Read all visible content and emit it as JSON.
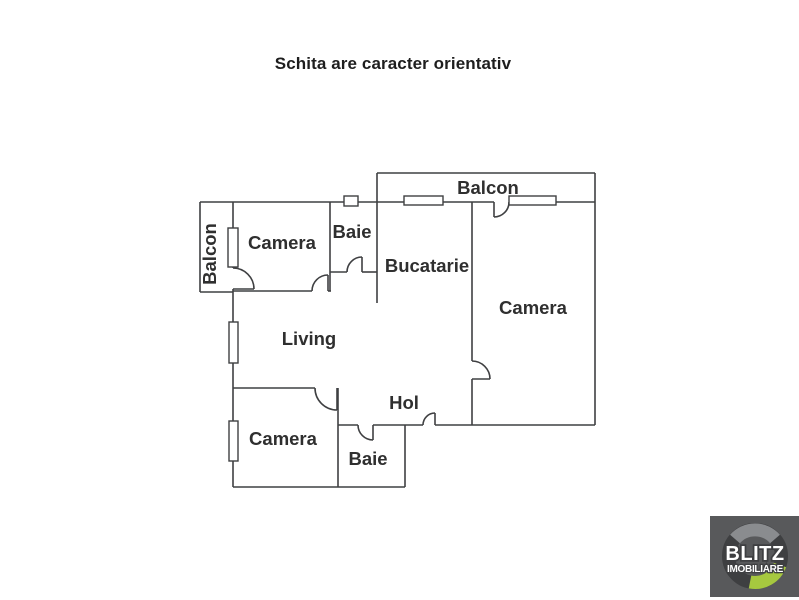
{
  "title": "Schita are caracter orientativ",
  "floorplan": {
    "rooms": [
      {
        "id": "balcon-left",
        "label": "Balcon"
      },
      {
        "id": "camera-top-left",
        "label": "Camera"
      },
      {
        "id": "baie-top",
        "label": "Baie"
      },
      {
        "id": "bucatarie",
        "label": "Bucatarie"
      },
      {
        "id": "balcon-top",
        "label": "Balcon"
      },
      {
        "id": "camera-right",
        "label": "Camera"
      },
      {
        "id": "living",
        "label": "Living"
      },
      {
        "id": "hol",
        "label": "Hol"
      },
      {
        "id": "camera-bottom",
        "label": "Camera"
      },
      {
        "id": "baie-bottom",
        "label": "Baie"
      }
    ],
    "colors": {
      "wall": "#3f4042",
      "label_text": "#2f2f2f",
      "background": "#ffffff"
    }
  },
  "logo": {
    "brand": "BLITZ",
    "subtitle": "IMOBILIARE",
    "colors": {
      "background": "#58595b",
      "ring_dark": "#3e3f41",
      "ring_light": "#8a8c8f",
      "ring_accent": "#a6c83f",
      "text": "#ffffff"
    }
  }
}
